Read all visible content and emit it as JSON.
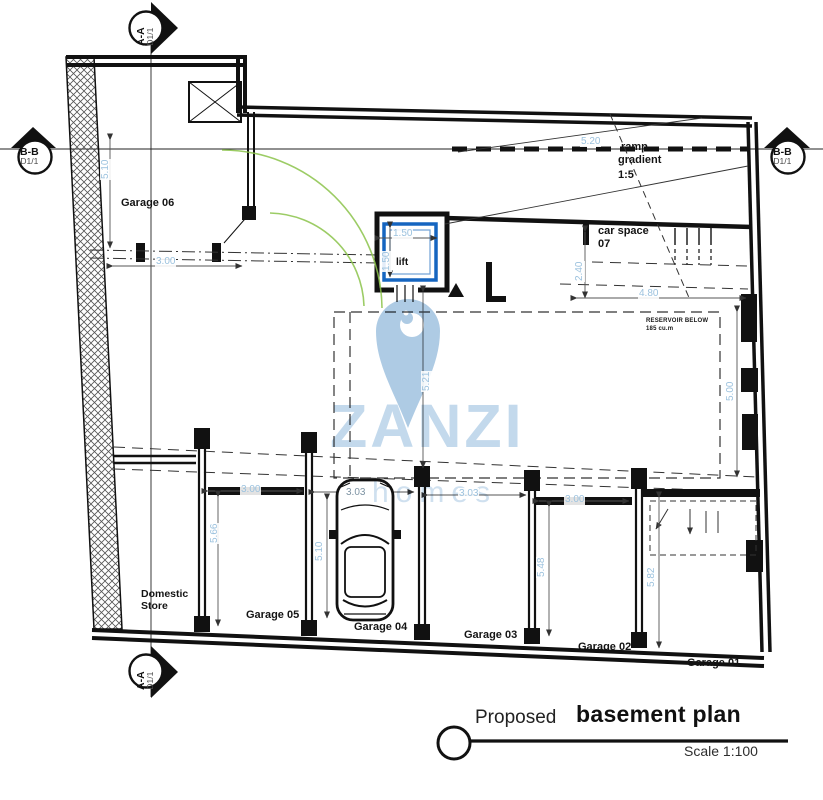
{
  "drawing": {
    "rooms": {
      "garage06": "Garage 06",
      "domestic1": "Domestic",
      "domestic2": "Store",
      "garage05": "Garage 05",
      "garage04": "Garage 04",
      "garage03": "Garage 03",
      "garage02": "Garage 02",
      "garage01": "Garage 01",
      "car_space1": "car space",
      "car_space2": "07",
      "lift": "lift"
    },
    "ramp": {
      "l1": "ramp",
      "l2": "gradient",
      "l3": "1:5"
    },
    "reservoir": {
      "l1": "RESERVOIR BELOW",
      "l2": "185 cu.m"
    },
    "dims": {
      "g06_h": "5.10",
      "g06_w": "3.00",
      "ramp_len": "5.20",
      "lift_w": "1.50",
      "lift_h": "1.50",
      "cs_d": "2.40",
      "res_w": "4.80",
      "res_h": "5.21",
      "right_side": "5.00",
      "g05_w": "3.00",
      "g05_d": "5.66",
      "g04_w": "3.03",
      "g04_d": "5.10",
      "g03_w": "3.03",
      "g02_w": "3.00",
      "g02_d": "5.48",
      "g01_d": "5.82"
    },
    "markers": {
      "aa": "A-A",
      "bb": "B-B",
      "sheet": "D1/1"
    },
    "title": {
      "prefix": "Proposed",
      "name": "basement plan",
      "scale": "Scale 1:100"
    },
    "watermark": {
      "brand": "ZANZI",
      "sub": "homes"
    },
    "colors": {
      "wall": "#111111",
      "dimension": "#9cc2de",
      "lift": "#1565c0",
      "turning_arc": "#8bc34a",
      "watermark": "#aecbe4"
    }
  }
}
